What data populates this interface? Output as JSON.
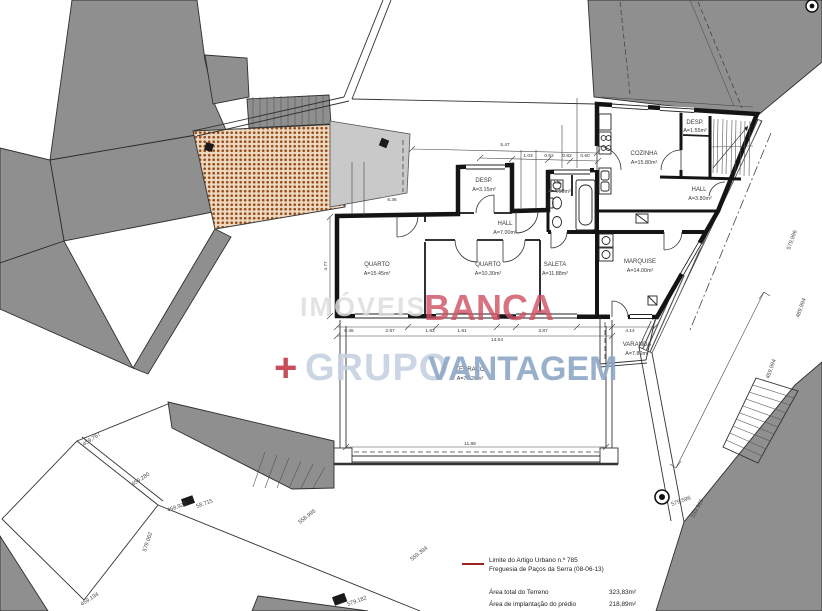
{
  "colors": {
    "accent_red": "#cf4f62",
    "plus_red": "#c23a4a",
    "light_gray_word": "#dedede",
    "light_blue_word": "#c7d1e0",
    "blue_word": "#8fa8c8",
    "legend_line": "#9c2222",
    "roof_hatch": "#9a4f1e",
    "building_gray": "#8f8f8f"
  },
  "watermark": {
    "word1": "IMÓVEIS",
    "word2": "BANCA",
    "plus": "+",
    "word3": "GRUPO",
    "word4": "VANTAGEM"
  },
  "rooms": [
    {
      "name": "QUARTO",
      "area": "A=15.45m²"
    },
    {
      "name": "QUARTO",
      "area": "A=10.30m²"
    },
    {
      "name": "SALETA",
      "area": "A=11.88m²"
    },
    {
      "name": "HALL",
      "area": "A=7.00m²"
    },
    {
      "name": "DESP.",
      "area": "A=3.15m²"
    },
    {
      "name": "I.S.",
      "area": "A=4.50m²"
    },
    {
      "name": "COZINHA",
      "area": "A=15.80m²"
    },
    {
      "name": "DESP.",
      "area": "A=1.55m²"
    },
    {
      "name": "HALL",
      "area": "A=3.80m²"
    },
    {
      "name": "MARQUISE",
      "area": "A=14.00m²"
    },
    {
      "name": "VARANDA",
      "area": "A=7.80m²"
    },
    {
      "name": "TERRAÇO",
      "area": "A=70.20m²"
    }
  ],
  "legend": {
    "boundary_label_line1": "Limite do Artigo Urbano n.º 785",
    "boundary_label_line2": "Freguesia de Paços da Serra (08-06-13)",
    "area_rows": [
      {
        "label": "Área total do Terreno",
        "value": "323,83m²"
      },
      {
        "label": "Área de implantação do prédio",
        "value": "218,89m²"
      }
    ]
  },
  "survey_labels": [
    {
      "text": "459.767"
    },
    {
      "text": "459.280"
    },
    {
      "text": "458.927"
    },
    {
      "text": "58.715"
    },
    {
      "text": "579.062"
    },
    {
      "text": "459.194"
    },
    {
      "text": "558.995"
    },
    {
      "text": "559.394"
    },
    {
      "text": "579.182"
    },
    {
      "text": "579.596"
    },
    {
      "text": "559.926"
    },
    {
      "text": "579.996"
    },
    {
      "text": "489.994"
    },
    {
      "text": "459.994"
    }
  ],
  "dimensions": [
    {
      "text": "5.47"
    },
    {
      "text": "1.03"
    },
    {
      "text": "0.62"
    },
    {
      "text": "0.82"
    },
    {
      "text": "0.60"
    },
    {
      "text": "6.36"
    },
    {
      "text": "4.77"
    },
    {
      "text": "14.04"
    },
    {
      "text": "0.45"
    },
    {
      "text": "2.87"
    },
    {
      "text": "1.83"
    },
    {
      "text": "1.81"
    },
    {
      "text": "3.87"
    },
    {
      "text": "4.14"
    },
    {
      "text": "11.88"
    }
  ]
}
